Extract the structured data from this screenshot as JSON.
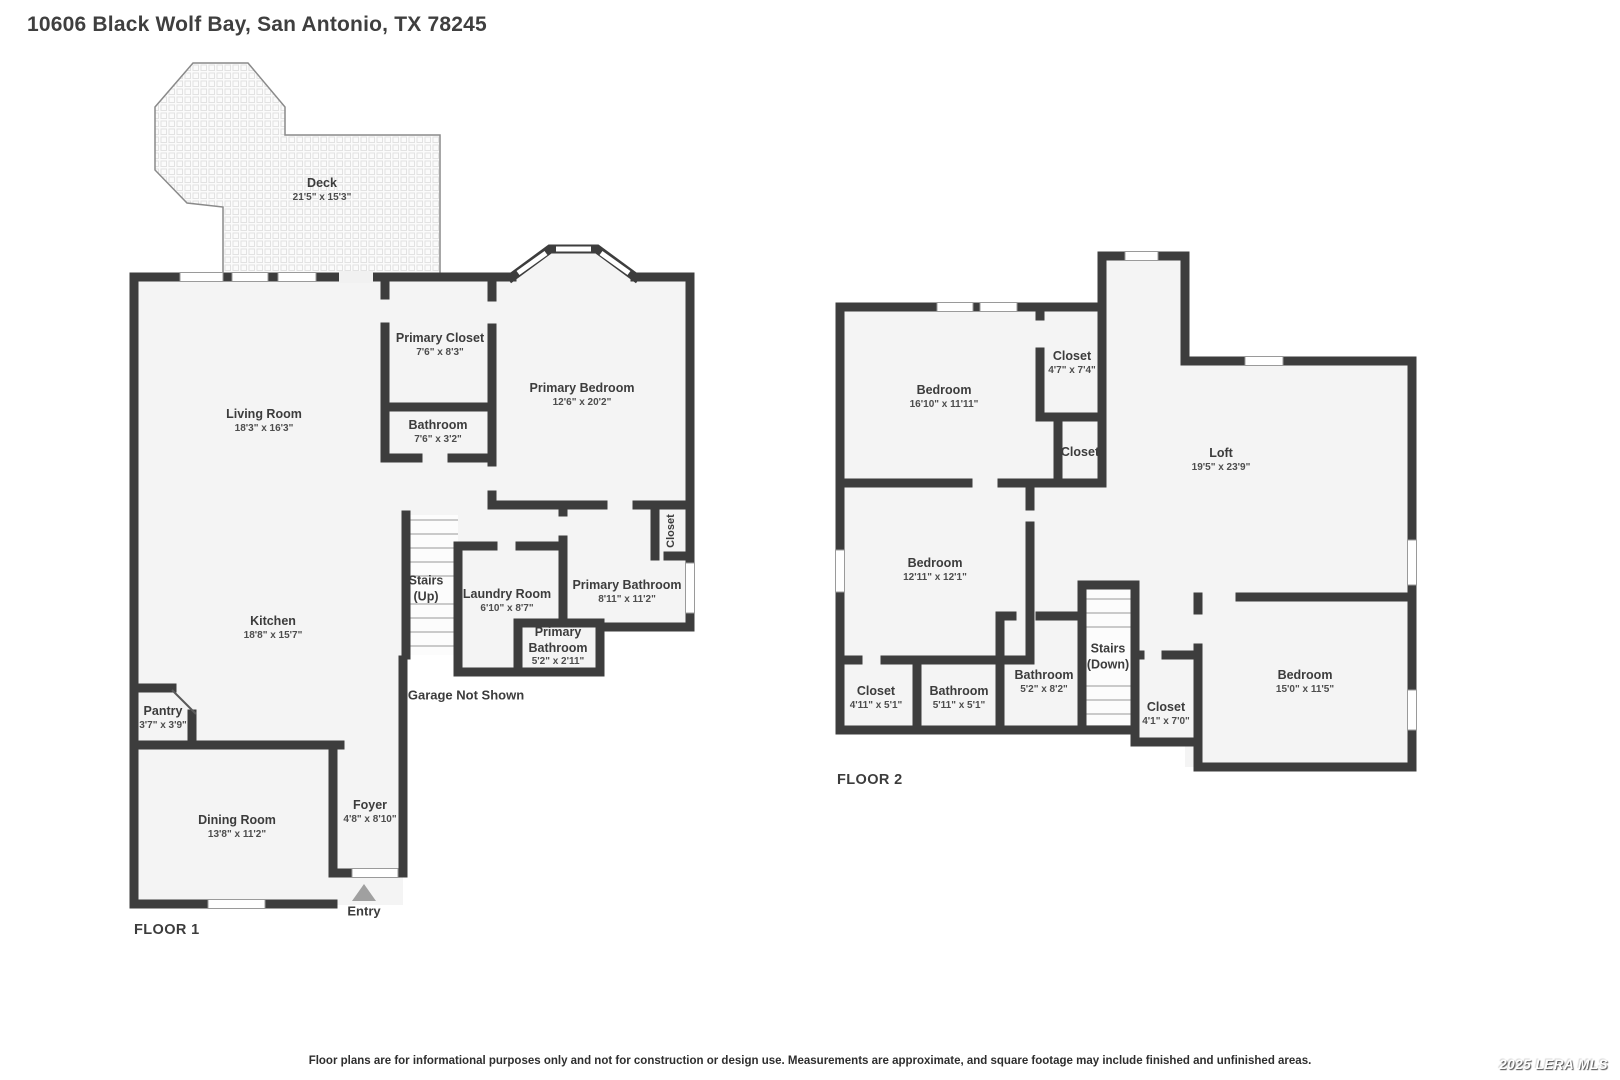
{
  "title": "10606 Black Wolf Bay, San Antonio, TX 78245",
  "floor1": {
    "label": "FLOOR 1",
    "deck": {
      "name": "Deck",
      "dims": "21'5\" x 15'3\""
    },
    "living_room": {
      "name": "Living Room",
      "dims": "18'3\" x 16'3\""
    },
    "primary_closet": {
      "name": "Primary Closet",
      "dims": "7'6\" x 8'3\""
    },
    "bathroom": {
      "name": "Bathroom",
      "dims": "7'6\" x 3'2\""
    },
    "primary_bedroom": {
      "name": "Primary Bedroom",
      "dims": "12'6\" x 20'2\""
    },
    "stairs": {
      "line1": "Stairs",
      "line2": "(Up)"
    },
    "laundry": {
      "name": "Laundry Room",
      "dims": "6'10\" x 8'7\""
    },
    "primary_bathroom": {
      "name": "Primary Bathroom",
      "dims": "8'11\" x 11'2\""
    },
    "closet": {
      "name": "Closet"
    },
    "primary_bathroom_small": {
      "line1": "Primary",
      "line2": "Bathroom",
      "dims": "5'2\" x 2'11\""
    },
    "kitchen": {
      "name": "Kitchen",
      "dims": "18'8\" x 15'7\""
    },
    "pantry": {
      "name": "Pantry",
      "dims": "3'7\" x 3'9\""
    },
    "dining_room": {
      "name": "Dining Room",
      "dims": "13'8\" x 11'2\""
    },
    "foyer": {
      "name": "Foyer",
      "dims": "4'8\" x 8'10\""
    },
    "garage_note": "Garage Not Shown",
    "entry_label": "Entry"
  },
  "floor2": {
    "label": "FLOOR 2",
    "bedroom_top": {
      "name": "Bedroom",
      "dims": "16'10\" x 11'11\""
    },
    "closet_top": {
      "name": "Closet",
      "dims": "4'7\" x 7'4\""
    },
    "closet_mid": {
      "name": "Closet"
    },
    "loft": {
      "name": "Loft",
      "dims": "19'5\" x 23'9\""
    },
    "bedroom_mid": {
      "name": "Bedroom",
      "dims": "12'11\" x 12'1\""
    },
    "closet_left": {
      "name": "Closet",
      "dims": "4'11\" x 5'1\""
    },
    "bathroom_left": {
      "name": "Bathroom",
      "dims": "5'11\" x 5'1\""
    },
    "bathroom_mid": {
      "name": "Bathroom",
      "dims": "5'2\" x 8'2\""
    },
    "stairs": {
      "line1": "Stairs",
      "line2": "(Down)"
    },
    "closet_small": {
      "name": "Closet",
      "dims": "4'1\" x 7'0\""
    },
    "bedroom_right": {
      "name": "Bedroom",
      "dims": "15'0\" x 11'5\""
    }
  },
  "footer": {
    "disclaimer": "Floor plans are for informational purposes only and not for construction or design use. Measurements are approximate, and square footage may include finished and unfinished areas.",
    "watermark": "2025 LERA MLS"
  },
  "colors": {
    "wall": "#3d3d3d",
    "room_fill": "#f4f4f4",
    "accent_gray": "#a0a0a0"
  }
}
